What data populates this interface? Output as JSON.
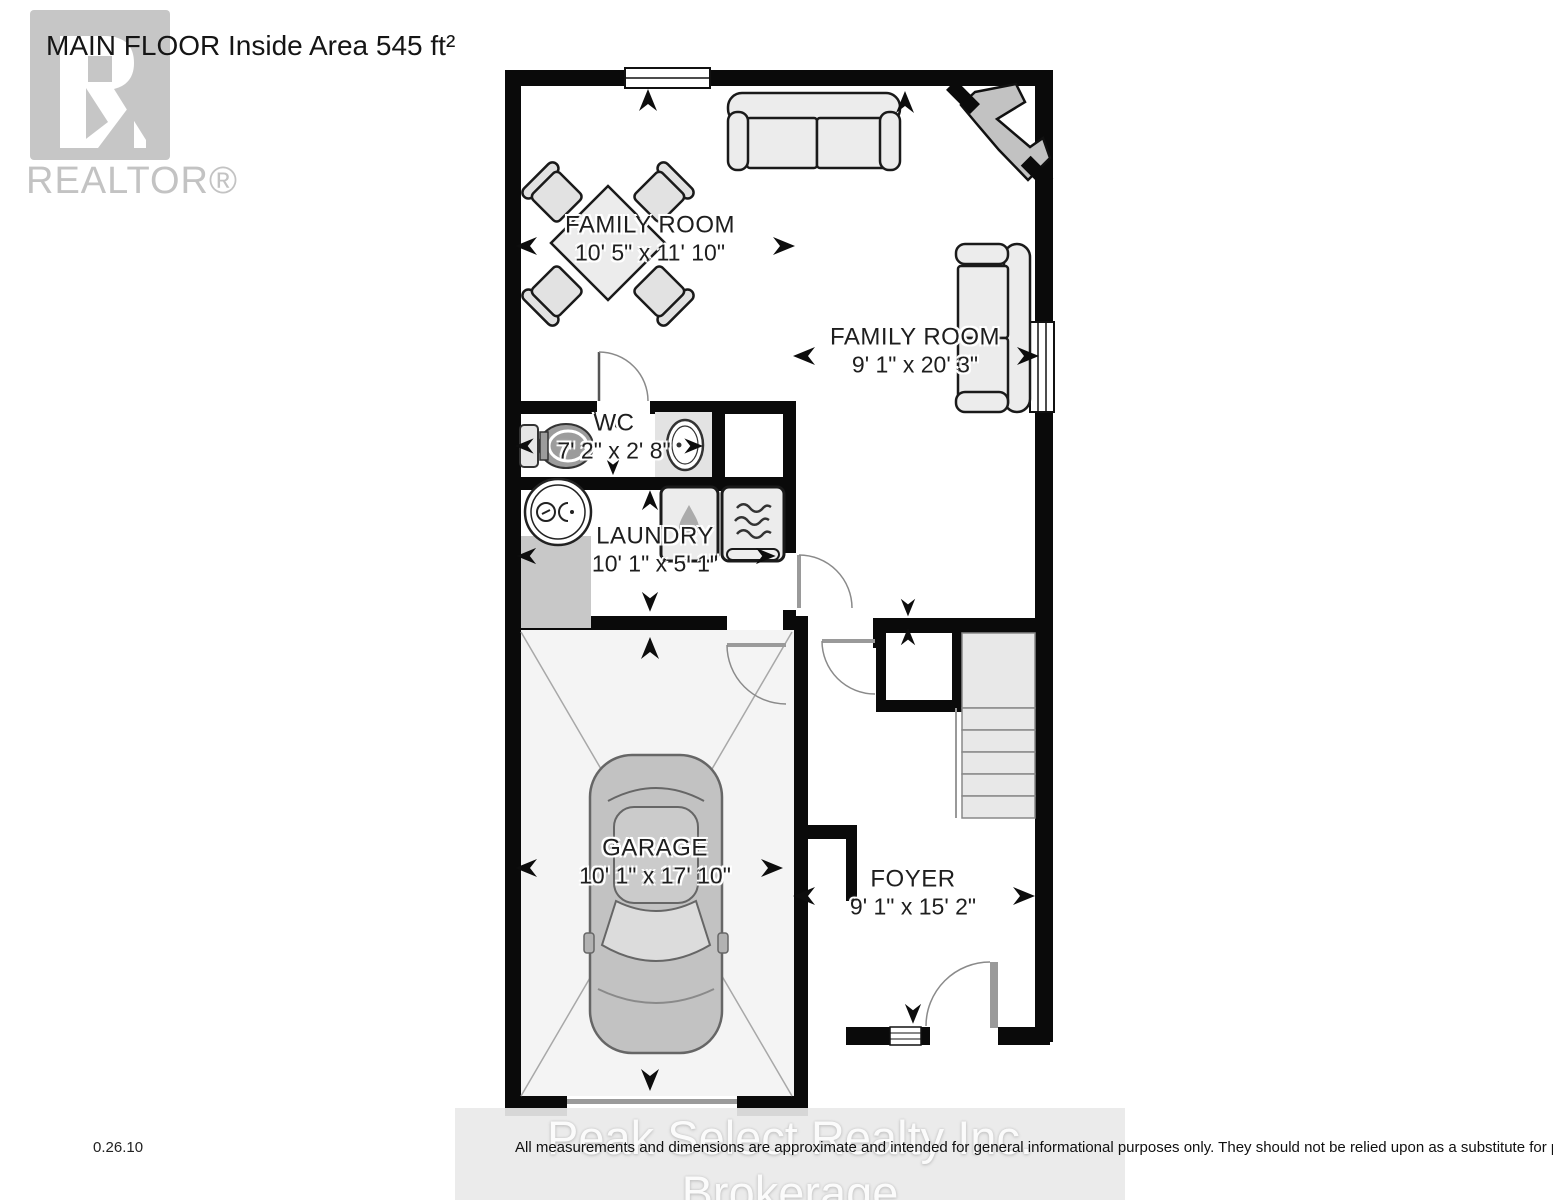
{
  "header": {
    "title": "MAIN FLOOR Inside Area 545 ft²"
  },
  "branding": {
    "realtor_logo_text": "REALTOR®",
    "brokerage_watermark": "Peak Select Realty Inc. Brokerage"
  },
  "rooms": [
    {
      "name": "FAMILY ROOM",
      "dimensions": "10' 5\" x 11' 10\""
    },
    {
      "name": "FAMILY ROOM",
      "dimensions": "9' 1\" x 20' 3\""
    },
    {
      "name": "WC",
      "dimensions": "7' 2\" x 2' 8\""
    },
    {
      "name": "LAUNDRY",
      "dimensions": "10' 1\" x 5' 1\""
    },
    {
      "name": "GARAGE",
      "dimensions": "10' 1\" x 17' 10\""
    },
    {
      "name": "FOYER",
      "dimensions": "9' 1\" x 15' 2\""
    }
  ],
  "footer": {
    "version": "0.26.10",
    "disclaimer": "All measurements and dimensions are approximate and intended for general informational purposes only. They should not be relied upon as a substitute for professional advice or accurate surveying."
  },
  "icons": [
    "realtor-block-r-icon",
    "window-icon",
    "door-swing-icon",
    "dimension-arrow-icon",
    "sofa-icon",
    "dining-table-icon",
    "chair-icon",
    "fireplace-icon",
    "toilet-icon",
    "sink-icon",
    "furnace-icon",
    "washer-icon",
    "dryer-icon",
    "car-icon",
    "stairs-icon",
    "entry-step-icon"
  ],
  "colors": {
    "wall": "#0a0a0a",
    "furniture_fill": "#e9e9e9",
    "appliance_stroke": "#1a1a1a",
    "floor": "#ffffff",
    "garage_floor": "#f4f4f4",
    "watermark_gray": "#c4c4c4",
    "landing_gray": "#c8c8c8"
  }
}
